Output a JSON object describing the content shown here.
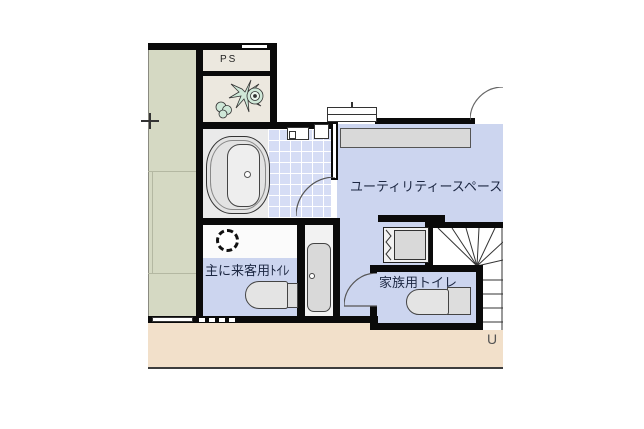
{
  "floor_plan": {
    "labels": {
      "pipe_space": "PS",
      "utility_space": "ユーティリティースペース",
      "guest_toilet": "主に来客用ﾄｲﾚ",
      "family_toilet": "家族用トイレ",
      "stairs_direction": "U"
    },
    "colors": {
      "room_blue": "#ccd5ef",
      "tile_blue": "#d6ddf5",
      "tatami_green": "#d5d9c3",
      "corridor_peach": "#f2e0ca",
      "service_cream": "#ece8df",
      "fixture_gray": "#d9d9d9",
      "wall_black": "#0a0a0a",
      "plant_green": "#cfe8d8"
    }
  }
}
